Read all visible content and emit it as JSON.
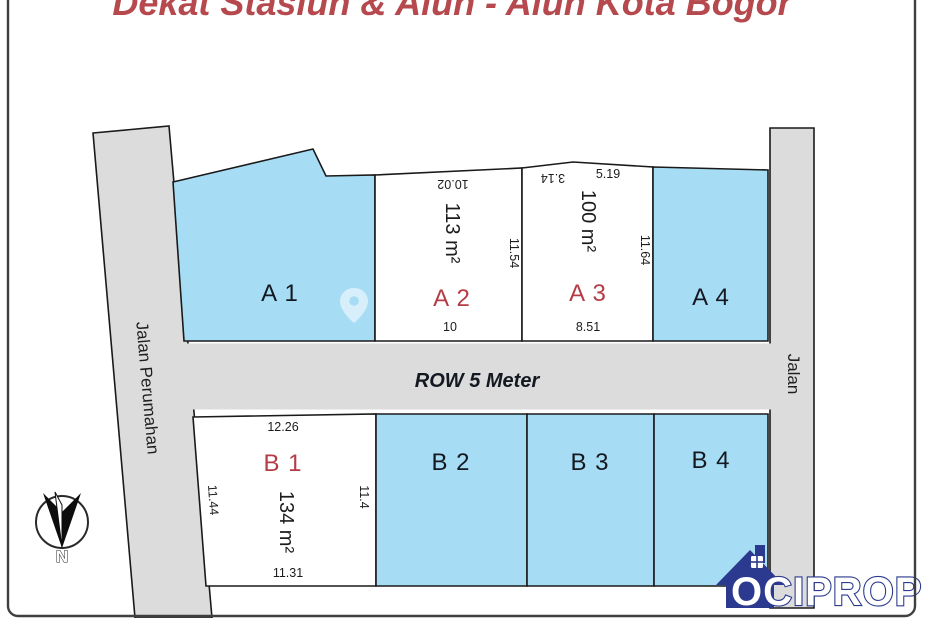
{
  "title": "Dekat Stasiun & Alun - Alun Kota Bogor",
  "colors": {
    "plot_blue": "#a7ddf4",
    "plot_white": "#ffffff",
    "road_gray": "#dcdcdc",
    "outline_black": "#1a1a1a",
    "label_red": "#b43c46",
    "title_red": "#b5494d",
    "logo_navy": "#2b3a8f"
  },
  "roads": {
    "left": "Jalan Perumahan",
    "right": "Jalan",
    "middle": "ROW 5 Meter"
  },
  "plots": {
    "a1": {
      "label": "A 1"
    },
    "a2": {
      "label": "A 2",
      "area": "113 m²",
      "dim_top": "10.02",
      "dim_bottom": "10",
      "dim_right": "11.54"
    },
    "a3": {
      "label": "A 3",
      "area": "100 m²",
      "dim_top_left": "3.14",
      "dim_top_right": "5.19",
      "dim_bottom": "8.51",
      "dim_right": "11.64"
    },
    "a4": {
      "label": "A 4"
    },
    "b1": {
      "label": "B 1",
      "area": "134 m²",
      "dim_top": "12.26",
      "dim_bottom": "11.31",
      "dim_left": "11.44",
      "dim_right": "11.4"
    },
    "b2": {
      "label": "B 2"
    },
    "b3": {
      "label": "B 3"
    },
    "b4": {
      "label": "B 4"
    }
  },
  "compass": {
    "letter": "N"
  },
  "logo": {
    "text": "OCIPROP"
  }
}
